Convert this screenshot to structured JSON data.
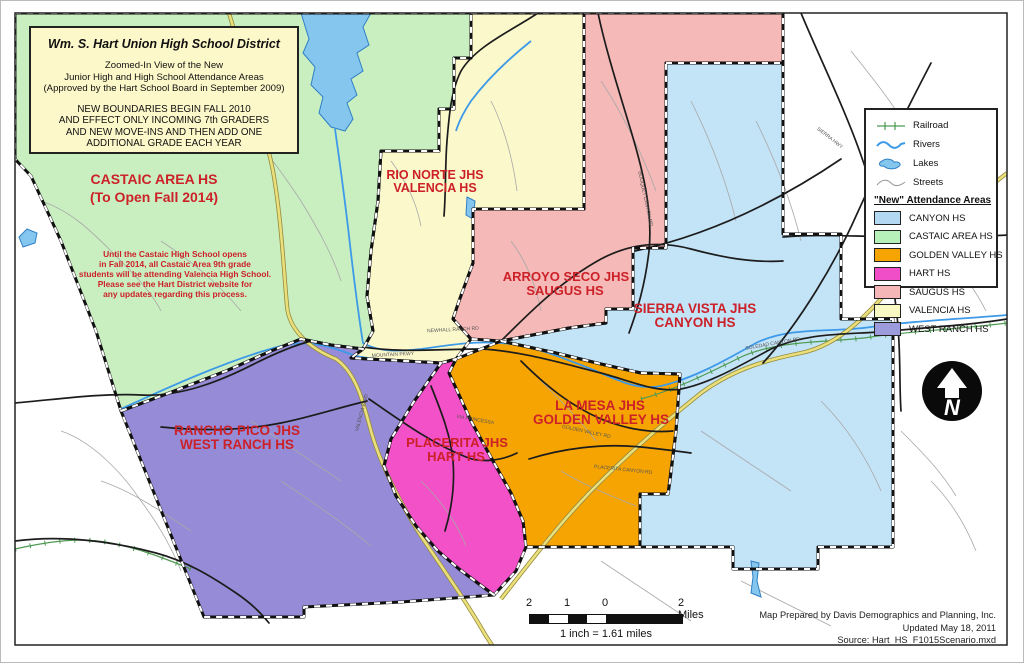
{
  "title_box": {
    "title": "Wm. S. Hart Union High School District",
    "subtitle_lines": [
      "Zoomed-In View of the New",
      "Junior High and High School Attendance Areas",
      "(Approved by the Hart School Board in September 2009)"
    ],
    "notice_lines": [
      "NEW BOUNDARIES BEGIN FALL 2010",
      "AND EFFECT ONLY INCOMING 7th GRADERS",
      "AND NEW MOVE-INS AND THEN ADD ONE",
      "ADDITIONAL GRADE EACH YEAR"
    ]
  },
  "castaic_note_lines": [
    "Until the Castaic High School opens",
    "in Fall 2014, all Castaic Area 9th grade",
    "students will be attending Valencia High School.",
    "Please see the Hart District website for",
    "any updates regarding this process."
  ],
  "region_labels": [
    {
      "line1": "CASTAIC AREA HS",
      "line2": "(To Open Fall 2014)"
    },
    {
      "line1": "RIO NORTE JHS",
      "line2": "VALENCIA HS"
    },
    {
      "line1": "ARROYO SECO JHS",
      "line2": "SAUGUS HS"
    },
    {
      "line1": "SIERRA VISTA JHS",
      "line2": "CANYON HS"
    },
    {
      "line1": "RANCHO PICO JHS",
      "line2": "WEST RANCH HS"
    },
    {
      "line1": "PLACERITA JHS",
      "line2": "HART HS"
    },
    {
      "line1": "LA MESA JHS",
      "line2": "GOLDEN VALLEY HS"
    }
  ],
  "legend": {
    "line_items": [
      {
        "label": "Railroad"
      },
      {
        "label": "Rivers"
      },
      {
        "label": "Lakes"
      },
      {
        "label": "Streets"
      }
    ],
    "header": "\"New\" Attendance Areas",
    "areas": [
      {
        "label": "CANYON HS",
        "color": "#b3d8f1"
      },
      {
        "label": "CASTAIC AREA HS",
        "color": "#b6f1ba"
      },
      {
        "label": "GOLDEN VALLEY HS",
        "color": "#f6a402"
      },
      {
        "label": "HART HS",
        "color": "#f04ec9"
      },
      {
        "label": "SAUGUS HS",
        "color": "#f4b6b6"
      },
      {
        "label": "VALENCIA HS",
        "color": "#f9f9c3"
      },
      {
        "label": "WEST RANCH HS",
        "color": "#9c9cdc"
      }
    ]
  },
  "regions": {
    "castaic": {
      "name": "CASTAIC AREA HS",
      "color": "#c9efc1"
    },
    "valencia": {
      "name": "VALENCIA HS",
      "color": "#fbf8cb"
    },
    "saugus": {
      "name": "SAUGUS HS",
      "color": "#f5b9b7"
    },
    "canyon": {
      "name": "CANYON HS",
      "color": "#c3e3f7"
    },
    "west_ranch": {
      "name": "WEST RANCH HS",
      "color": "#968bd7"
    },
    "hart": {
      "name": "HART HS",
      "color": "#f351c8"
    },
    "golden_valley": {
      "name": "GOLDEN VALLEY HS",
      "color": "#f6a402"
    }
  },
  "north_arrow": {
    "letter": "N"
  },
  "scale_bar": {
    "ticks": [
      "2",
      "1",
      "0"
    ],
    "right_label": "2 Miles",
    "caption": "1 inch = 1.61 miles"
  },
  "credits_lines": [
    "Map Prepared by Davis Demographics and Planning, Inc.",
    "Updated May 18, 2011",
    "Source: Hart_HS_F1015Scenario.mxd"
  ],
  "colors": {
    "label_red": "#cc2128",
    "river_blue": "#3d9ae8",
    "railroad_green": "#4f9a53",
    "highway_yellow": "#e9e07b",
    "title_box_bg": "#fcf8c9"
  },
  "road_labels": [
    {
      "text": "NEWHALL RANCH RD",
      "x": 452,
      "y": 330,
      "rot": -3
    },
    {
      "text": "MOUNTAIN PKWY",
      "x": 392,
      "y": 355,
      "rot": -3
    },
    {
      "text": "VALENCIA BLVD",
      "x": 362,
      "y": 412,
      "rot": -75
    },
    {
      "text": "GOLDEN VALLEY RD",
      "x": 585,
      "y": 432,
      "rot": 12
    },
    {
      "text": "PLACERITA CANYON RD",
      "x": 622,
      "y": 470,
      "rot": 6
    },
    {
      "text": "VIA PRINCESSA",
      "x": 474,
      "y": 420,
      "rot": 10
    },
    {
      "text": "SIERRA HWY",
      "x": 828,
      "y": 138,
      "rot": 38
    },
    {
      "text": "SOLEDAD CANYON RD",
      "x": 772,
      "y": 344,
      "rot": -10
    },
    {
      "text": "BOUQUET CANYON RD",
      "x": 643,
      "y": 198,
      "rot": 78
    }
  ]
}
